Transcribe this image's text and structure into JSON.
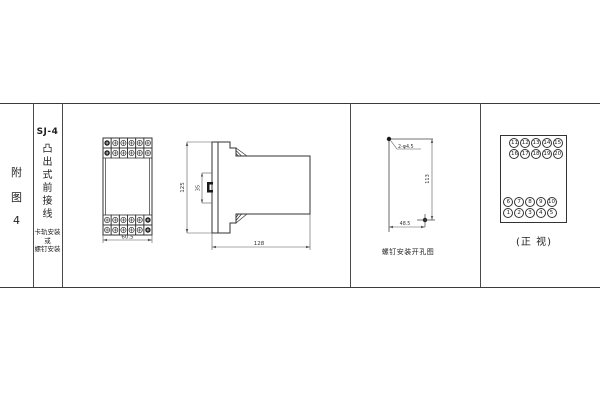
{
  "figure": {
    "index_label": {
      "chars": [
        "附",
        "图",
        "4"
      ]
    },
    "model_label": {
      "model": "SJ-4",
      "type_chars": [
        "凸",
        "出",
        "式",
        "前",
        "接",
        "线"
      ],
      "mounting": [
        "卡轨安装",
        "或",
        "螺钉安装"
      ]
    },
    "front_view": {
      "width_dim": "60.5"
    },
    "side_view": {
      "height_dim": "125",
      "rail_dim": "35",
      "depth_dim": "128"
    },
    "drill_view": {
      "holes_label": "2-φ4.5",
      "vertical_dim": "113",
      "horizontal_dim": "48.5",
      "caption": "螺钉安装开孔图"
    },
    "terminal_view": {
      "rows": [
        [
          "11",
          "12",
          "13",
          "14",
          "15"
        ],
        [
          "16",
          "17",
          "18",
          "19",
          "20"
        ],
        [
          "6",
          "7",
          "8",
          "9",
          "10"
        ],
        [
          "1",
          "2",
          "3",
          "4",
          "5"
        ]
      ],
      "caption": "(正 视)"
    },
    "grid": {
      "cols": 6,
      "rows": 2,
      "top_dark_col": 0,
      "bottom_dark_col": 5
    }
  }
}
